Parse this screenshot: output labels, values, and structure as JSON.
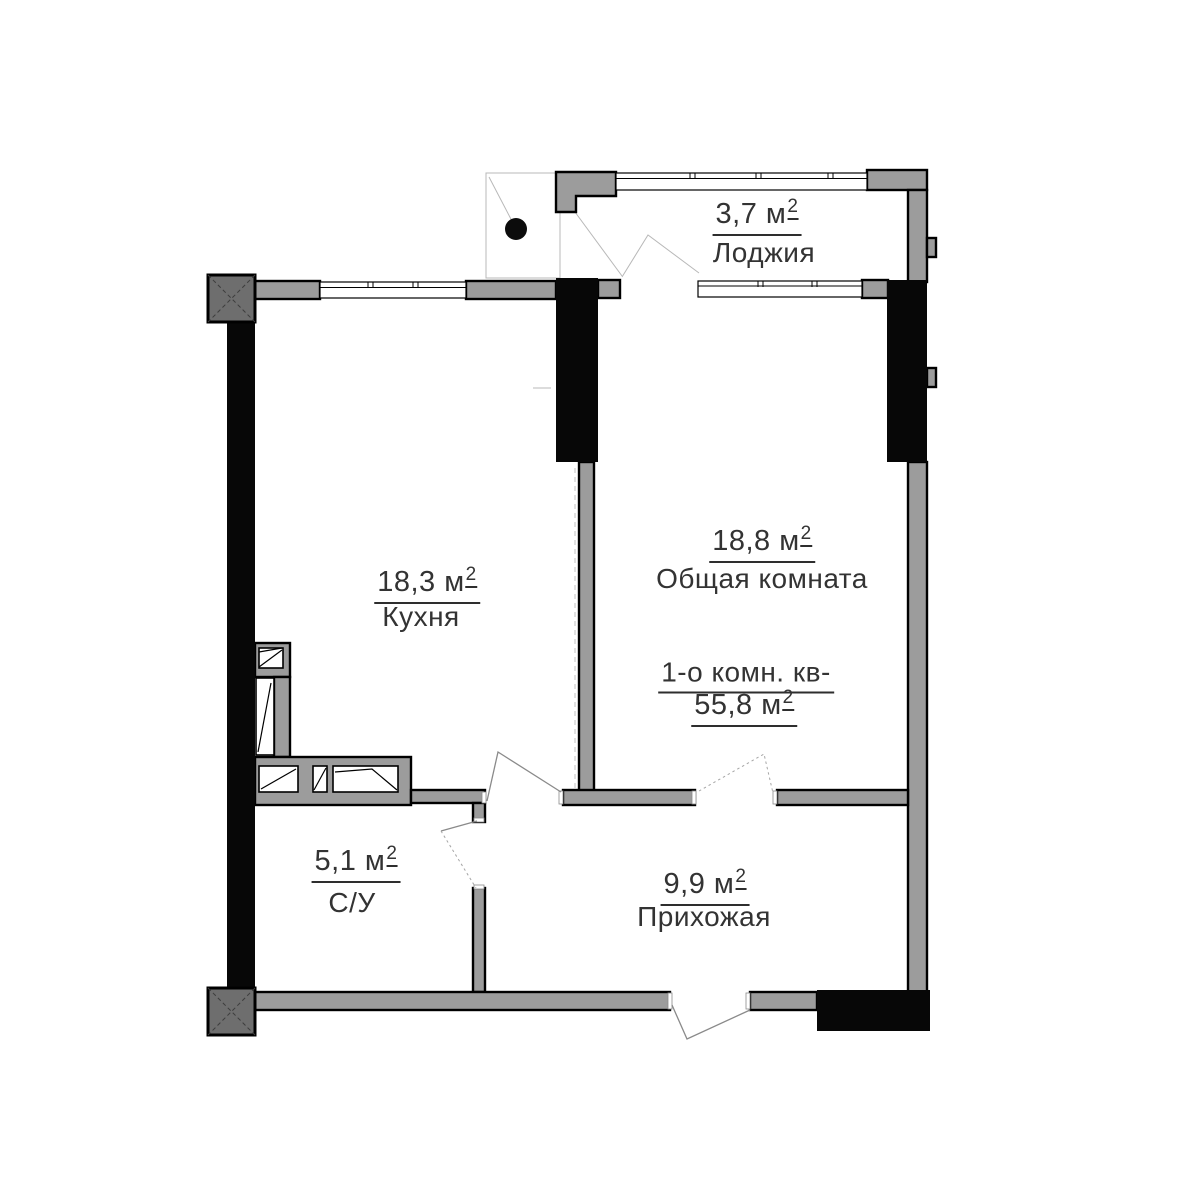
{
  "colors": {
    "bg": "#ffffff",
    "wall_gray": "#9c9c9c",
    "wall_dark": "#070707",
    "column_fill": "#6e6e6e",
    "outline": "#000000",
    "text_color": "#333333",
    "thin_line": "#b8b8b8"
  },
  "apartment": {
    "title_line": "1-о комн. кв-",
    "total_area": "55,8 м",
    "total_area_sup": "2"
  },
  "rooms": {
    "loggia": {
      "name": "Лоджия",
      "area": "3,7 м",
      "sup": "2"
    },
    "living": {
      "name": "Общая комната",
      "area": "18,8 м",
      "sup": "2"
    },
    "kitchen": {
      "name": "Кухня",
      "area": "18,3 м",
      "sup": "2"
    },
    "bathroom": {
      "name": "С/У",
      "area": "5,1 м",
      "sup": "2"
    },
    "hallway": {
      "name": "Прихожая",
      "area": "9,9 м",
      "sup": "2"
    }
  },
  "icons": {
    "drain": "floor-drain-dot",
    "columns": "crossed-column-marker"
  }
}
